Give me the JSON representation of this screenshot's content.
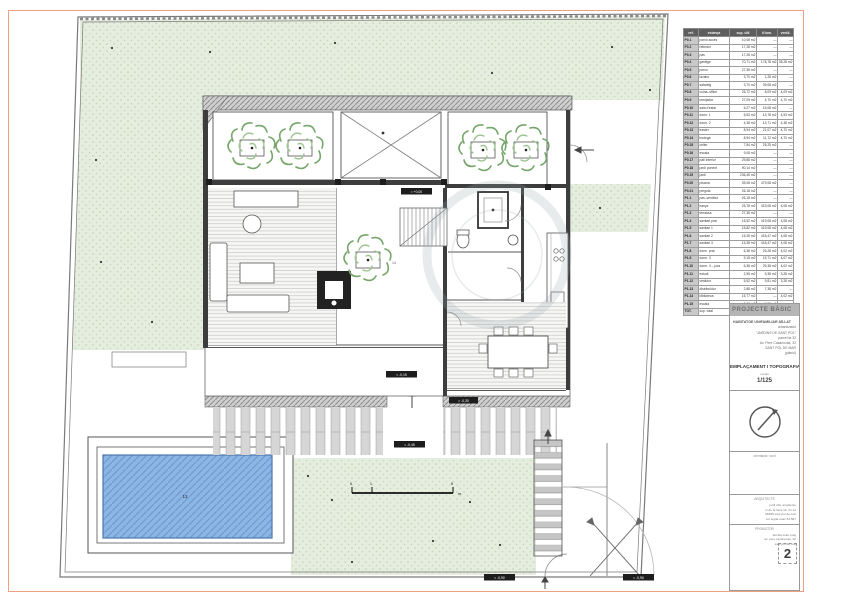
{
  "sheet": {
    "page_number": "2",
    "border_color": "#eda084"
  },
  "colors": {
    "grass": "#e5edde",
    "pool_water": "#8cb6e4",
    "tree_green": "#76a66a",
    "wall_gray": "#3d3d3d"
  },
  "table": {
    "headers": [
      "ref.",
      "estança",
      "sup. útil",
      "il·lum.",
      "ventil."
    ],
    "rows": [
      [
        "P0.1",
        "porxo accés",
        "10,08 m2",
        "—",
        "—"
      ],
      [
        "P0.2",
        "rebedor",
        "17,28 m2",
        "—",
        "—"
      ],
      [
        "P0.3",
        "pas",
        "17,28 m2",
        "—",
        "—"
      ],
      [
        "P0.4",
        "garatge",
        "70,71 m2",
        "178,78 m2",
        "35,28 m2"
      ],
      [
        "P0.5",
        "porxo",
        "27,38 m2",
        "—",
        "—"
      ],
      [
        "P0.6",
        "lavabo",
        "3,70 m2",
        "1,28 m2",
        "—"
      ],
      [
        "P0.7",
        "safareig",
        "3,70 m2",
        "39,08 m2",
        "—"
      ],
      [
        "P0.8",
        "cuina–office",
        "25,72 m2",
        "8,09 m2",
        "4,09 m2"
      ],
      [
        "P0.9",
        "menjador",
        "27,09 m2",
        "4,70 m2",
        "4,70 m2"
      ],
      [
        "P0.10",
        "sala d'estar",
        "5,27 m2",
        "15,08 m2",
        "—"
      ],
      [
        "P0.11",
        "dorm. 1",
        "5,53 m2",
        "13,78 m2",
        "4,53 m2"
      ],
      [
        "P0.12",
        "dorm. 2",
        "4,38 m2",
        "13,71 m2",
        "4,38 m2"
      ],
      [
        "P0.13",
        "traster",
        "8,94 m2",
        "21,07 m2",
        "4,70 m2"
      ],
      [
        "P0.14",
        "bodega",
        "8,94 m2",
        "11,72 m2",
        "4,70 m2"
      ],
      [
        "P0.15",
        "celler",
        "7,84 m2",
        "25,25 m2",
        "—"
      ],
      [
        "P0.16",
        "escala",
        "9,08 m2",
        "—",
        "—"
      ],
      [
        "P0.17",
        "pati interior",
        "29,86 m2",
        "—",
        "—"
      ],
      [
        "P0.18",
        "jardí ponent",
        "90,14 m2",
        "—",
        "—"
      ],
      [
        "P0.19",
        "jardí",
        "236,45 m2",
        "—",
        "—"
      ],
      [
        "P0.20",
        "piscina",
        "35,08 m2",
        "479,08 m2",
        "—"
      ],
      [
        "P0.21",
        "pèrgola",
        "26,18 m2",
        "—",
        "—"
      ],
      [
        "P1.1",
        "pas–vestíbul",
        "26,18 m2",
        "—",
        "—"
      ],
      [
        "P1.2",
        "banys",
        "25,78 m2",
        "419,08 m2",
        "4,08 m2"
      ],
      [
        "P1.3",
        "terrassa",
        "27,38 m2",
        "—",
        "—"
      ],
      [
        "P1.4",
        "sanitari pral.",
        "15,52 m2",
        "419,08 m2",
        "4,08 m2"
      ],
      [
        "P1.5",
        "sanitari 1",
        "15,82 m2",
        "419,08 m2",
        "4,08 m2"
      ],
      [
        "P1.6",
        "sanitari 2",
        "15,28 m2",
        "418,47 m2",
        "4,08 m2"
      ],
      [
        "P1.7",
        "sanitari 3",
        "15,38 m2",
        "418,47 m2",
        "4,08 m2"
      ],
      [
        "P1.8",
        "dorm. pral.",
        "6,38 m2",
        "25,28 m2",
        "4,02 m2"
      ],
      [
        "P1.9",
        "dorm. 3",
        "9,15 m2",
        "15,71 m2",
        "4,07 m2"
      ],
      [
        "P1.10",
        "dorm. 4 – jocs",
        "6,38 m2",
        "25,38 m2",
        "4,02 m2"
      ],
      [
        "P1.11",
        "estudi",
        "2,55 m2",
        "9,38 m2",
        "3,28 m2"
      ],
      [
        "P1.12",
        "vestidor",
        "5,52 m2",
        "9,81 m2",
        "3,28 m2"
      ],
      [
        "P1.13",
        "distribuïdor",
        "2,88 m2",
        "7,38 m2",
        "—"
      ],
      [
        "P1.14",
        "biblioteca",
        "15,77 m2",
        "—",
        "4,02 m2"
      ],
      [
        "P1.15",
        "escala",
        "3,08 m2",
        "5,08 m2",
        "—"
      ],
      [
        "TOT.",
        "sup. total",
        "29,25 m2",
        "419,08 m2",
        "4,08 m2"
      ]
    ]
  },
  "titleblock": {
    "header": "PROJECTE BÀSIC",
    "project_lines": [
      "HABITATGE UNIFAMILIAR AÏLLAT",
      "urbanització",
      "\"JARDINS DE SANT POL\"",
      "parcel·la 32",
      "Av. Pere Casanovas, 32",
      "SANT POL DE MAR",
      "(plànol)"
    ],
    "drawing_title": "EMPLAÇAMENT I TOPOGRAFIA",
    "scale_label": "escala",
    "scale_value": "1/125",
    "north_caption": "orientació: nord",
    "architect_label": "ARQUITECTE",
    "architect_lines": [
      "jordi vilà, arquitecte",
      "c/ de la riera 14, 2n 1a",
      "08395 sant pol de mar",
      "col·legiat coac 34.567"
    ],
    "promoter_label": "PROMOTOR",
    "promoter_lines": [
      "família soler puig",
      "av. pere casanovas, 32",
      "sant pol de mar"
    ]
  },
  "plan": {
    "labels": {
      "lvl_a": "≈ +0,00",
      "lvl_b": "≈ -0,15",
      "lvl_c": "≈ -0,45",
      "lvl_d": "≈ -0,90",
      "lvl_e": "≈ -0,90",
      "lvl_f": "≈ -0,30",
      "pool_number": "13",
      "patio_number": "14",
      "scale_tick_0": "0",
      "scale_tick_1": "1",
      "scale_tick_5": "5",
      "scale_unit": "m"
    }
  }
}
